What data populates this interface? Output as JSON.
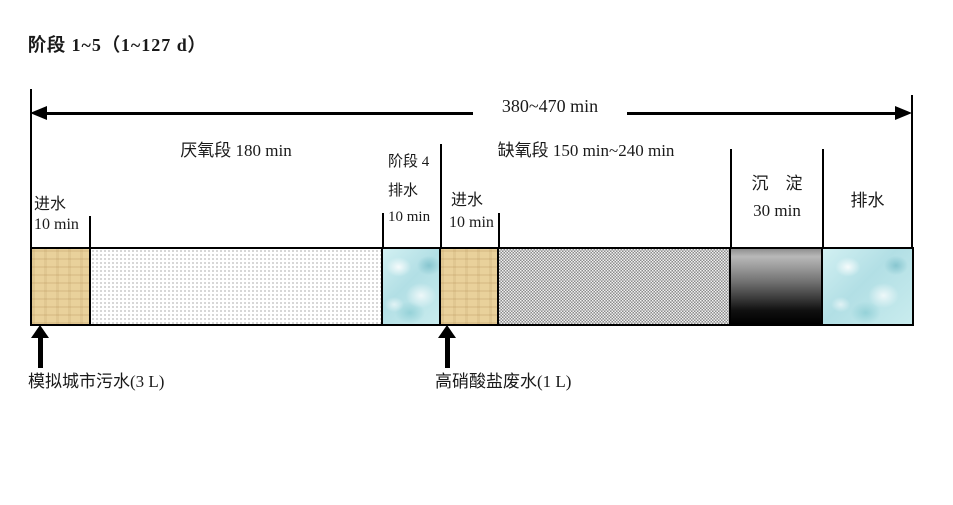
{
  "title": "阶段 1~5（1~127 d）",
  "top_arrow": {
    "total_label": "380~470 min"
  },
  "phases": {
    "anaerobic_label": "厌氧段 180 min",
    "anoxic_label": "缺氧段 150 min~240 min",
    "settle_name": "沉　淀",
    "settle_time": "30 min",
    "drain_label": "排水"
  },
  "sublabels": {
    "influent1_name": "进水",
    "influent1_time": "10 min",
    "phase4_line1": "阶段 4",
    "phase4_line2": "排水",
    "phase4_line3": "10 min",
    "influent2_name": "进水",
    "influent2_time": "10 min"
  },
  "bottom": {
    "municipal_label": "模拟城市污水(3 L)",
    "nitrate_label": "高硝酸盐废水(1 L)"
  },
  "segments": [
    {
      "name": "influent-1",
      "label": "进水 10 min",
      "texture": "tan"
    },
    {
      "name": "anaerobic",
      "label": "厌氧段 180 min",
      "texture": "dots"
    },
    {
      "name": "phase4-drain",
      "label": "阶段 4 排水 10 min",
      "texture": "water"
    },
    {
      "name": "influent-2",
      "label": "进水 10 min",
      "texture": "tan"
    },
    {
      "name": "anoxic",
      "label": "缺氧段 150 min~240 min",
      "texture": "checker"
    },
    {
      "name": "settle",
      "label": "沉淀 30 min",
      "texture": "gradient"
    },
    {
      "name": "drain",
      "label": "排水",
      "texture": "water"
    }
  ],
  "colors": {
    "line": "#000000",
    "influent_tan": "#e9d19b",
    "water_blue": "#bfe6ea",
    "checker_gray": "#8c8c8c",
    "settle_black": "#000000",
    "background": "#ffffff"
  }
}
